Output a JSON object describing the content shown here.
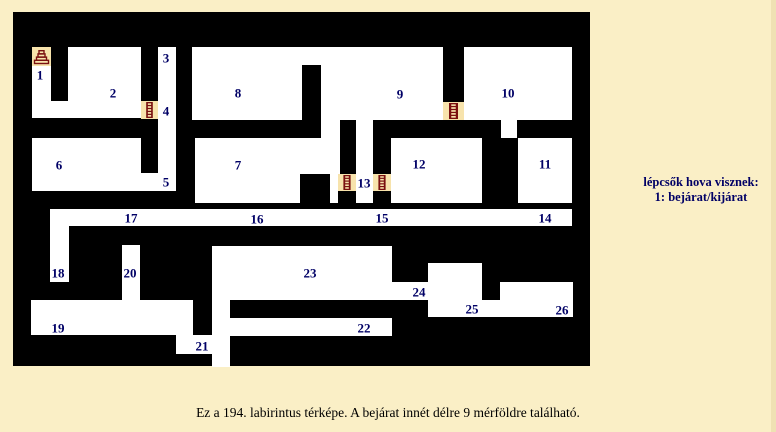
{
  "page": {
    "caption": "Ez a 194. labirintus térképe. A bejárat innét délre 9 mérföldre található.",
    "bg_color": "#FAEFC6",
    "edge_color": "#EFE1B3",
    "caption_color": "#000000"
  },
  "legend": {
    "line1": "lépcsők hova visznek:",
    "line2": "1: bejárat/kijárat",
    "color": "#000066"
  },
  "map": {
    "x": 13,
    "y": 12,
    "w": 577,
    "h": 354,
    "colors": {
      "wall": "#000000",
      "floor": "#FFFFFF",
      "stair_bg": "#F7E3AC",
      "stair_fg": "#7A1010",
      "label": "#000066"
    },
    "rooms": [
      [
        19,
        54,
        19,
        37
      ],
      [
        19,
        89,
        109,
        17
      ],
      [
        55,
        35,
        73,
        55
      ],
      [
        145,
        35,
        18,
        144
      ],
      [
        19,
        126,
        109,
        53
      ],
      [
        128,
        161,
        17,
        18
      ],
      [
        179,
        35,
        380,
        73
      ],
      [
        488,
        108,
        16,
        18
      ],
      [
        308,
        108,
        19,
        18
      ],
      [
        343,
        108,
        17,
        18
      ],
      [
        343,
        126,
        17,
        65
      ],
      [
        182,
        126,
        145,
        36
      ],
      [
        182,
        162,
        105,
        29
      ],
      [
        317,
        162,
        8,
        29
      ],
      [
        378,
        126,
        91,
        65
      ],
      [
        505,
        126,
        54,
        65
      ],
      [
        37,
        197,
        522,
        17
      ],
      [
        37,
        214,
        19,
        56
      ],
      [
        109,
        233,
        18,
        55
      ],
      [
        18,
        288,
        162,
        35
      ],
      [
        163,
        323,
        53,
        19
      ],
      [
        199,
        234,
        18,
        121
      ],
      [
        199,
        234,
        180,
        54
      ],
      [
        379,
        270,
        36,
        18
      ],
      [
        415,
        251,
        54,
        37
      ],
      [
        415,
        288,
        145,
        17
      ],
      [
        487,
        270,
        73,
        18
      ],
      [
        217,
        306,
        162,
        18
      ]
    ],
    "pillars": [
      [
        289,
        53,
        19,
        55
      ],
      [
        430,
        35,
        21,
        55
      ]
    ],
    "stairs": [
      {
        "kind": "stairs",
        "rect": [
          19,
          35,
          19,
          19
        ]
      },
      {
        "kind": "ladder",
        "rect": [
          128,
          89,
          17,
          18
        ]
      },
      {
        "kind": "ladder",
        "rect": [
          430,
          90,
          21,
          18
        ]
      },
      {
        "kind": "ladder",
        "rect": [
          325,
          162,
          18,
          17
        ]
      },
      {
        "kind": "ladder",
        "rect": [
          360,
          162,
          18,
          17
        ]
      }
    ],
    "labels": [
      {
        "n": "1",
        "x": 27,
        "y": 63
      },
      {
        "n": "2",
        "x": 100,
        "y": 81
      },
      {
        "n": "3",
        "x": 153,
        "y": 46
      },
      {
        "n": "4",
        "x": 153,
        "y": 99
      },
      {
        "n": "5",
        "x": 153,
        "y": 170
      },
      {
        "n": "6",
        "x": 46,
        "y": 153
      },
      {
        "n": "7",
        "x": 225,
        "y": 153
      },
      {
        "n": "8",
        "x": 225,
        "y": 81
      },
      {
        "n": "9",
        "x": 387,
        "y": 82
      },
      {
        "n": "10",
        "x": 495,
        "y": 81
      },
      {
        "n": "11",
        "x": 532,
        "y": 152
      },
      {
        "n": "12",
        "x": 406,
        "y": 152
      },
      {
        "n": "13",
        "x": 351,
        "y": 171
      },
      {
        "n": "14",
        "x": 532,
        "y": 206
      },
      {
        "n": "15",
        "x": 369,
        "y": 206
      },
      {
        "n": "16",
        "x": 244,
        "y": 207
      },
      {
        "n": "17",
        "x": 118,
        "y": 206
      },
      {
        "n": "18",
        "x": 45,
        "y": 261
      },
      {
        "n": "19",
        "x": 45,
        "y": 316
      },
      {
        "n": "20",
        "x": 117,
        "y": 261
      },
      {
        "n": "21",
        "x": 189,
        "y": 334
      },
      {
        "n": "22",
        "x": 351,
        "y": 316
      },
      {
        "n": "23",
        "x": 297,
        "y": 261
      },
      {
        "n": "24",
        "x": 406,
        "y": 280
      },
      {
        "n": "25",
        "x": 459,
        "y": 297
      },
      {
        "n": "26",
        "x": 549,
        "y": 298
      }
    ]
  }
}
